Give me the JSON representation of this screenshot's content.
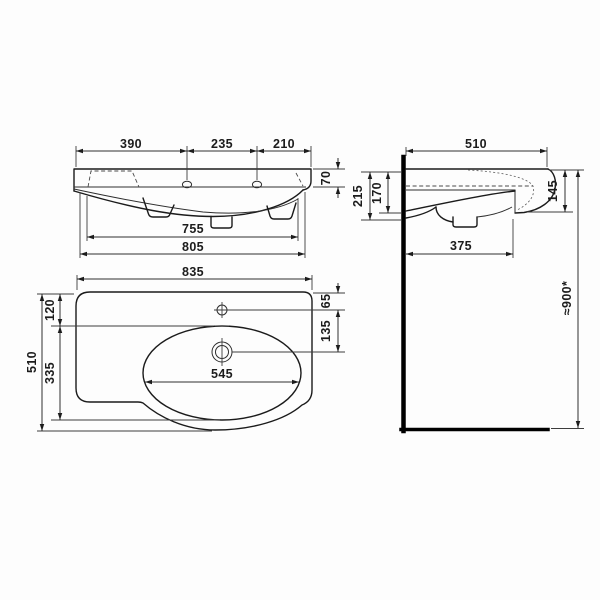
{
  "front_view": {
    "faucet_left_offset": "390",
    "faucet_spacing": "235",
    "faucet_right_offset": "210",
    "rim_height": "70",
    "width_inner": "755",
    "width_outer": "805"
  },
  "side_view": {
    "depth": "510",
    "front_drop": "215",
    "basin_drop": "170",
    "edge_height": "145",
    "trap_depth": "375",
    "mount_height": "≈900*"
  },
  "top_view": {
    "width": "835",
    "depth": "510",
    "basin_top_offset": "120",
    "basin_length": "335",
    "basin_width": "545",
    "faucet_offset": "65",
    "drain_offset": "135"
  },
  "colors": {
    "line": "#1b1b1b",
    "dimension": "#2e2e2e",
    "wall": "#000000",
    "background": "#fdfdfd"
  }
}
